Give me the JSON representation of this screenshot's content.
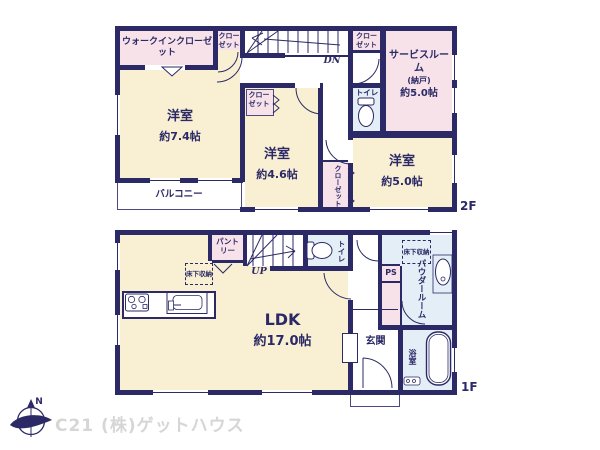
{
  "colors": {
    "wall_navy": "#2b2a66",
    "room_beige": "#f9efd3",
    "closet_pink": "#f8e2ea",
    "wet_blue": "#e4eef7",
    "watermark_gray": "#d6d6d6"
  },
  "floor2": {
    "label": "2F",
    "walk_in_closet": "ウォークインクローゼット",
    "closet_a": "クローゼット",
    "closet_b": "クローゼット",
    "closet_c": "クローゼット",
    "closet_d": "クローゼット",
    "stairs_dn": "DN",
    "toilet": "トイレ",
    "service_room": {
      "name": "サービスルーム",
      "sub": "(納戸)",
      "size": "約5.0帖"
    },
    "bedroom_a": {
      "name": "洋室",
      "size": "約7.4帖"
    },
    "bedroom_b": {
      "name": "洋室",
      "size": "約4.6帖"
    },
    "bedroom_c": {
      "name": "洋室",
      "size": "約5.0帖"
    },
    "balcony": "バルコニー"
  },
  "floor1": {
    "label": "1F",
    "ldk": {
      "name": "LDK",
      "size": "約17.0帖"
    },
    "pantry": "パントリー",
    "underfloor_storage_a": "床下収納",
    "underfloor_storage_b": "床下収納",
    "stairs_up": "UP",
    "toilet": "トイレ",
    "pipe_space": "PS",
    "powder_room": "パウダールーム",
    "entrance": "玄関",
    "bathroom": "浴室"
  },
  "compass": {
    "north": "N"
  },
  "watermark": "C21 (株)ゲットハウス"
}
